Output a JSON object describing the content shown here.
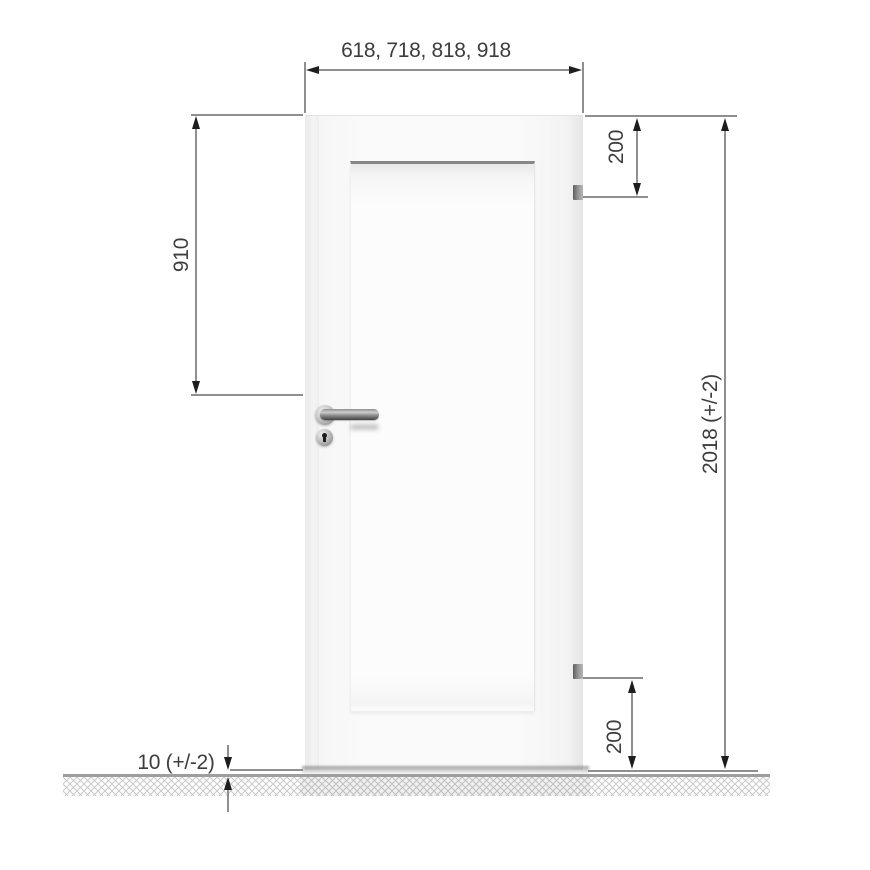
{
  "diagram": {
    "dimension_labels": {
      "door_width_options": "618, 718, 818, 918",
      "handle_height": "910",
      "top_hinge_offset": "200",
      "door_height": "2018 (+/-2)",
      "bottom_hinge_offset": "200",
      "floor_clearance": "10 (+/-2)"
    },
    "colors": {
      "dimension_line": "#8f8f8f",
      "arrowhead": "#1d1d1d",
      "label_text": "#3d3d3d",
      "floor_line": "#9e9e9e",
      "hatch_line": "#c9c9c9",
      "panel_shadow_line": "#878787",
      "door_face": "#f8f8f8",
      "door_panel": "#fdfdfd",
      "hinge_metal": "#8c8c8c",
      "handle_metal": "#6f6f6f"
    }
  }
}
